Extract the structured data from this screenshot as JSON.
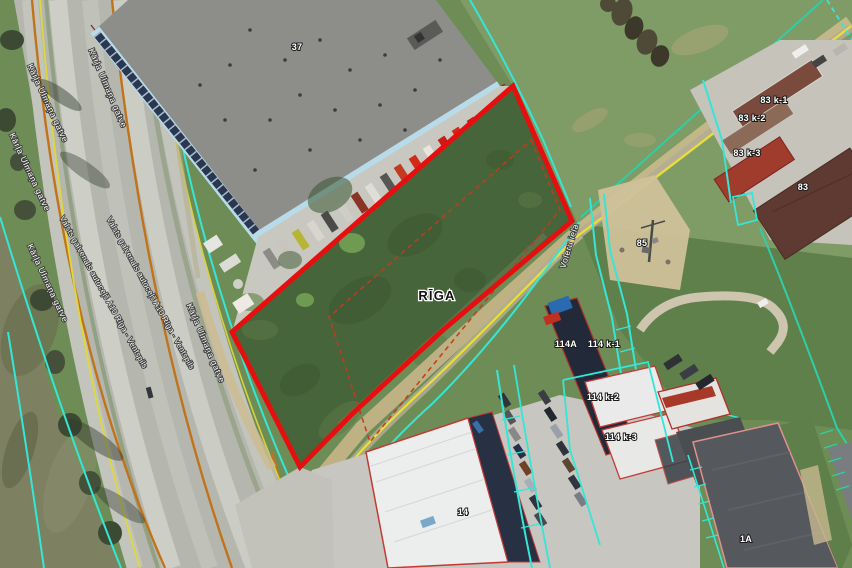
{
  "map": {
    "city_label": "RĪGA",
    "street_labels": {
      "voleru": "Voleru iela",
      "karla_ulmana": "Kārļa Ulmaņa gatve",
      "valsts_a10": "Valsts galvenais autoceļš A10 Rīga - Ventspils"
    },
    "parcel_labels": {
      "b37": "37",
      "p83k1": "83 k-1",
      "p83k2": "83 k-2",
      "p83k3": "83 k-3",
      "p83": "83",
      "p85": "85",
      "p114a": "114A",
      "p114k1": "114 k-1",
      "p114k2": "114 k-2",
      "p114k3": "114 k-3",
      "p14": "14",
      "p1a": "1A"
    },
    "colors": {
      "selected_parcel_outline": "#e60f0f",
      "inner_boundary_dashed": "#c23b1e",
      "cadastral_boundary_cyan": "#35e6d6",
      "cadastral_boundary_teal": "#2ecfa8",
      "road_centerline_yellow": "#e8e032",
      "road_edge_orange": "#c2731a"
    }
  }
}
